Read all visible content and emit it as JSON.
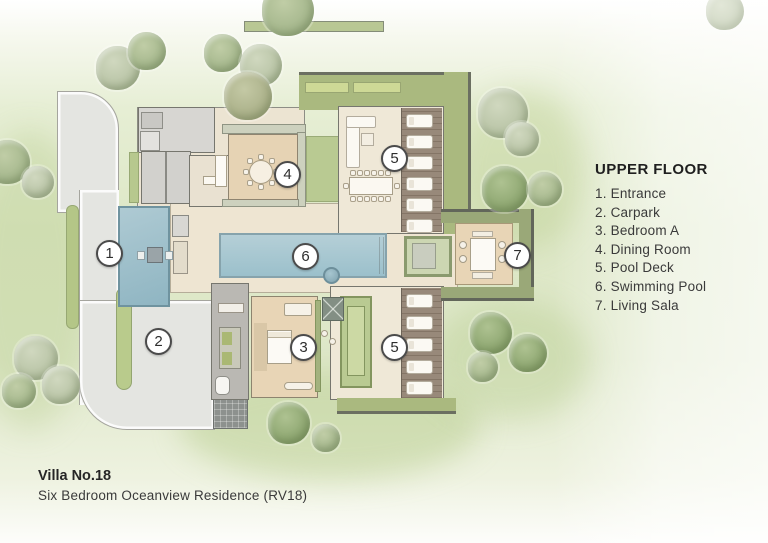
{
  "legend": {
    "title": "UPPER FLOOR",
    "items": [
      "1. Entrance",
      "2. Carpark",
      "3. Bedroom A",
      "4. Dining Room",
      "5. Pool Deck",
      "6. Swimming Pool",
      "7. Living Sala"
    ]
  },
  "footer": {
    "title": "Villa No.18",
    "subtitle": "Six Bedroom Oceanview Residence (RV18)"
  },
  "markers": {
    "entrance": "1",
    "carpark": "2",
    "bedroom_a": "3",
    "dining_room": "4",
    "pool_deck_north": "5",
    "pool_deck_south": "5",
    "swimming_pool": "6",
    "living_sala": "7"
  },
  "colors": {
    "lawn": "#dde7c6",
    "hedge_green": "#aab97f",
    "pool_blue": "#a7c8d2",
    "pond_blue": "#9cc1cc",
    "floor_tan": "#e8d5b6",
    "floor_cream": "#efe8d7",
    "driveway_gray": "#e4e5e1",
    "wall_gray": "#76766e",
    "deck_wood": "#98897a"
  }
}
